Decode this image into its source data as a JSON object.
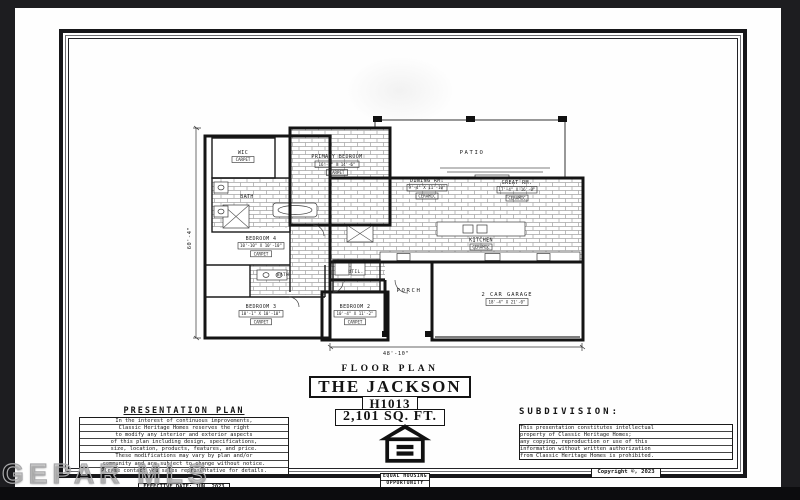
{
  "watermark": {
    "text": "GEPAR MLS"
  },
  "colors": {
    "background": "#1d1d20",
    "paper": "#fefefe",
    "ink": "#141414",
    "letterbox": "#0c0c0e"
  },
  "plan": {
    "dims": {
      "width_label": "48'-10\"",
      "height_label": "60'-4\""
    },
    "rooms": {
      "patio": {
        "name": "PATIO"
      },
      "wic": {
        "name": "WIC",
        "floor": "CARPET"
      },
      "primary_bedroom": {
        "name": "PRIMARY BEDROOM",
        "size": "16'-0\" X 14'-6\"",
        "floor": "CARPET"
      },
      "primary_bath": {
        "name": "BATH"
      },
      "dining": {
        "name": "DINING RM.",
        "size": "9'-4\" X 11'-10\"",
        "floor": "CERAMIC"
      },
      "great": {
        "name": "GREAT RM.",
        "size": "17'-4\" X 16'-0\"",
        "floor": "CERAMIC"
      },
      "kitchen": {
        "name": "KITCHEN",
        "floor": "CERAMIC"
      },
      "bedroom4": {
        "name": "BEDROOM 4",
        "size": "10'-10\" X 10'-10\"",
        "floor": "CARPET"
      },
      "bath2": {
        "name": "BATH"
      },
      "bedroom3": {
        "name": "BEDROOM 3",
        "size": "10'-1\" X 10'-10\"",
        "floor": "CARPET"
      },
      "bedroom2": {
        "name": "BEDROOM 2",
        "size": "10'-4\" X 11'-2\"",
        "floor": "CARPET"
      },
      "utility": {
        "name": "UTIL."
      },
      "porch": {
        "name": "PORCH"
      },
      "garage": {
        "name": "2 CAR GARAGE",
        "size": "18'-4\" X 21'-0\""
      }
    }
  },
  "title_block": {
    "label": "FLOOR PLAN",
    "plan_name": "THE  JACKSON",
    "plan_number": "H1013",
    "square_feet": "2,101  SQ.  FT."
  },
  "presentation": {
    "heading": "PRESENTATION PLAN",
    "lines": [
      "In the interest of continuous improvements,",
      "Classic Heritage Homes reserves the right",
      "to modify any interior and exterior aspects",
      "of this plan including design, specifications,",
      "size, location, products, features, and price.",
      "These modifications may vary by plan and/or",
      "community and are subject to change without notice.",
      "Please contact you sales representative for details."
    ],
    "effective_date": "EFFECTIVE DATE: JUN. 2023"
  },
  "equal_housing": {
    "line1": "EQUAL  HOUSING",
    "line2": "OPPORTUNITY"
  },
  "subdivision": {
    "label": "SUBDIVISION:"
  },
  "copyright": {
    "lines": [
      "This presentation constitutes intellectual",
      "property of Classic Heritage Homes;",
      "any copying, reproduction or use of this",
      "information without written authorization",
      "from Classic Heritage Homes is prohibited."
    ],
    "notice": "Copyright ©, 2023"
  }
}
